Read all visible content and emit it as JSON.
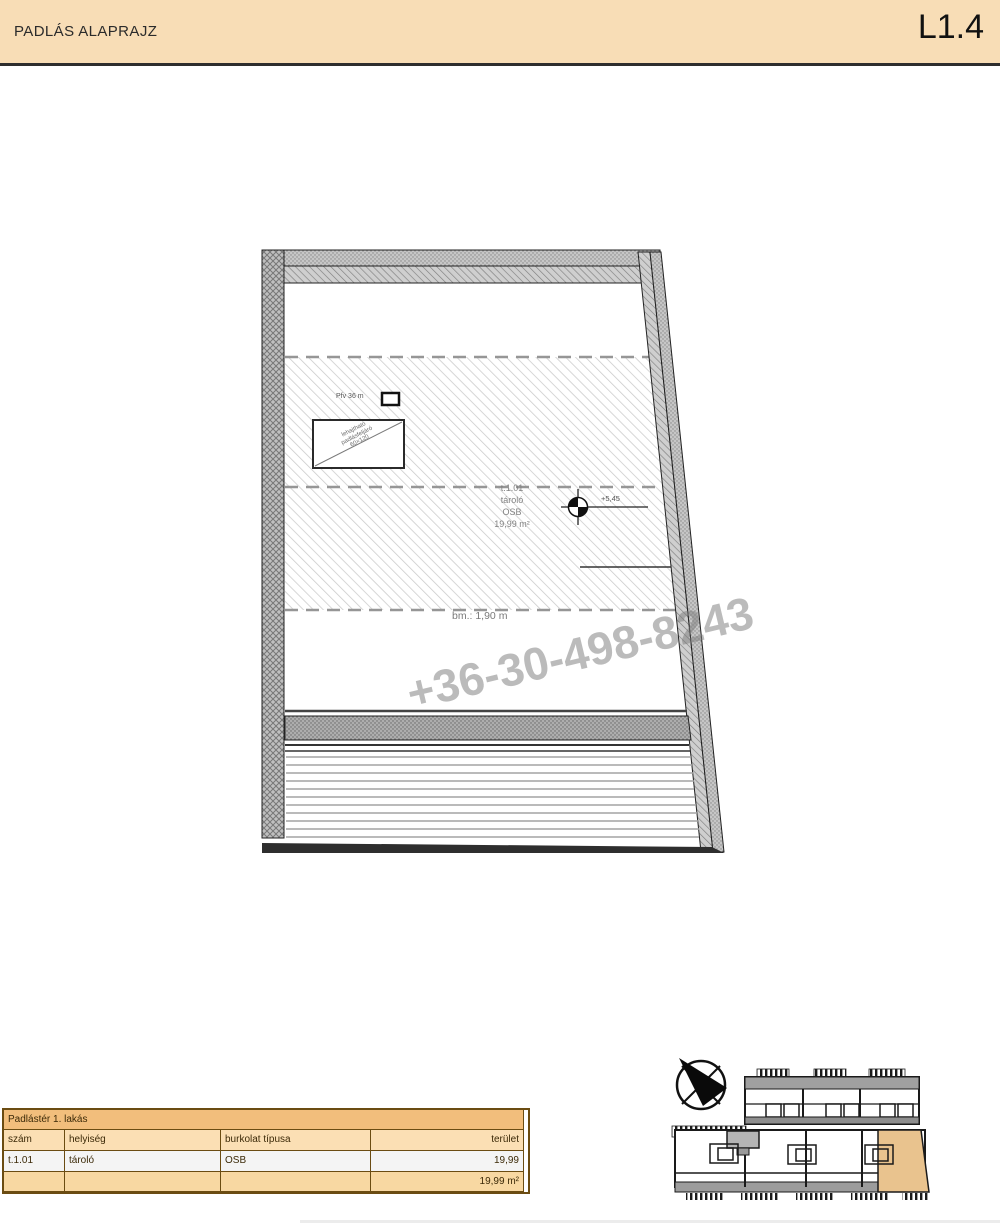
{
  "header": {
    "title": "PADLÁS ALAPRAJZ",
    "sheet_number": "L1.4",
    "band_color": "#F8DDB6"
  },
  "watermark": {
    "phone": "+36-30-498-8243"
  },
  "plan": {
    "room_label": {
      "number": "t.1.01",
      "name": "tároló",
      "surface": "OSB",
      "area": "19,99 m²"
    },
    "level_marker_value": "+5,45",
    "clear_height_note": "bm.: 1,90 m",
    "roof_window_label": "Pfv 36 m",
    "access_hatch_stamp": {
      "line1": "lehajtható",
      "line2": "padlásfeljáró",
      "line3": "60×120"
    }
  },
  "room_table": {
    "title": "Padlástér 1. lakás",
    "columns": {
      "number": "szám",
      "room": "helyiség",
      "finish": "burkolat típusa",
      "area": "terület"
    },
    "row": {
      "number": "t.1.01",
      "room": "tároló",
      "finish": "OSB",
      "area": "19,99"
    },
    "total_area": "19,99 m²"
  },
  "key_plan": {
    "highlight_color": "#E9C38E"
  },
  "icons": {
    "north_arrow": "north-arrow-icon",
    "level_marker": "level-marker-icon"
  }
}
